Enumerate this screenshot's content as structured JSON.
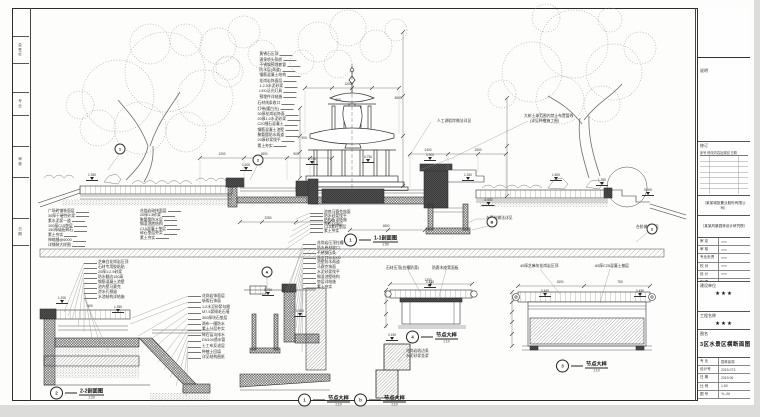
{
  "sheet": {
    "bg": "#dcdcda",
    "paper": "#fdfdfc",
    "line": "#333333"
  },
  "margin_blocks": [
    {
      "y": 36,
      "h": 26,
      "t": "会签栏"
    },
    {
      "y": 92,
      "h": 22,
      "t": "专业"
    },
    {
      "y": 146,
      "h": 30,
      "t": "审核"
    },
    {
      "y": 218,
      "h": 26,
      "t": "日期"
    }
  ],
  "stacks": [
    {
      "name": "fountain-upper-notes",
      "x": 300,
      "y": 52,
      "lh": 5.3,
      "anchor": "right",
      "leader": "right",
      "lines": [
        "黄锈石压顶",
        "涌泉喷头铜质",
        "不锈钢预埋套管",
        "防水层(两道)",
        "钢筋混凝土结构",
        "花岗岩饰面层",
        "1:2.5水泥砂浆",
        "LED泛光灯具",
        "预埋件详结施"
      ]
    },
    {
      "name": "fountain-lower-notes",
      "x": 300,
      "y": 101,
      "lh": 5.3,
      "anchor": "right",
      "leader": "right",
      "lines": [
        "石材线条收口",
        "灯带(暖白光)",
        "30厚花岗岩饰面",
        "20厚1:2水泥砂浆",
        "C20细石混凝土",
        "钢筋混凝土池壁",
        "聚氨酯防水两道",
        "20厚砂浆找平",
        "素土夯实"
      ]
    },
    {
      "name": "paving-layers-notes",
      "x": 48,
      "y": 209,
      "lh": 4.9,
      "anchor": "left",
      "leader": "right",
      "lines": [
        "广场砖铺装面层",
        "30厚干硬性砂浆",
        "素水泥浆一道",
        "100厚C15垫层",
        "150厚级配碎石",
        "素土夯实",
        "伸缩缝@6000",
        "详铺装大样图"
      ]
    },
    {
      "name": "pool-floor-notes",
      "x": 140,
      "y": 209,
      "lh": 4.5,
      "anchor": "left",
      "leader": "right",
      "lines": [
        "花岗岩碎拼面层",
        "20厚1:3砂浆",
        "聚氨酯防水层",
        "钢混池底结构",
        "C15混凝土垫层",
        "碎石垫层夯实",
        "素土夯实"
      ]
    },
    {
      "name": "basin-floor-notes",
      "x": 310,
      "y": 211,
      "lh": 3.9,
      "anchor": "left",
      "leader": "left",
      "lines": [
        "池底马赛克饰面",
        "防水砂浆找平",
        "结构板详结施",
        "陶粒回填层",
        "C15素砼垫层",
        "素土夯实"
      ]
    },
    {
      "name": "detailA-notes",
      "x": 303,
      "y": 241,
      "lh": 4.9,
      "anchor": "left",
      "leader": "left",
      "lines": [
        "花岗岩压顶拉槽",
        "防水卷材收口",
        "不锈钢压条",
        "溢水口@3000",
        "池壁防水两道",
        "马赛克饰面",
        "水泥砂浆找平",
        "钢混池壁结构",
        "垫层详结施",
        "素土夯实"
      ]
    },
    {
      "name": "detail1-top-notes",
      "x": 84,
      "y": 260,
      "lh": 5.0,
      "anchor": "left",
      "leader": "left",
      "lines": [
        "芝麻白花岗岩压顶",
        "石材专用胶粘贴",
        "20厚1:2.5砂浆",
        "防水翻边150高",
        "钢筋混凝土池壁",
        "池内壁马赛克",
        "泄水孔预留",
        "水池结构详结施"
      ]
    },
    {
      "name": "detail1-right-notes",
      "x": 188,
      "y": 293,
      "lh": 5.6,
      "anchor": "left",
      "leader": "left",
      "lines": [
        "花岗岩饰面层",
        "斩假石饰面",
        "1:2水泥砂浆勾缝",
        "M7.5浆砌毛石墙",
        "300厚块石垫层",
        "两布一膜防水",
        "素土分层夯实",
        "碎石盲沟排水",
        "DN100透水管",
        "土工布反滤层",
        "种植土回填",
        "详见结构图纸"
      ]
    }
  ],
  "notes": [
    {
      "x": 437,
      "y": 119,
      "t": "人工湖驳岸做法详见"
    },
    {
      "x": 524,
      "y": 114,
      "t": "大树土球范围内禁止布置管线"
    },
    {
      "x": 530,
      "y": 119,
      "t": "(详见种植施工图)"
    },
    {
      "x": 486,
      "y": 216,
      "t": "水泵坑做法详见"
    },
    {
      "x": 636,
      "y": 225,
      "t": "台阶做法详见"
    },
    {
      "x": 386,
      "y": 266,
      "t": "石材压顶(拉槽防滑)"
    },
    {
      "x": 432,
      "y": 266,
      "t": "防腐木座凳面板"
    },
    {
      "x": 520,
      "y": 264,
      "t": "40厚芝麻灰花岗岩压顶"
    },
    {
      "x": 595,
      "y": 264,
      "t": "60厚C25混凝土基层"
    },
    {
      "x": 406,
      "y": 349,
      "t": "花岗岩收边条"
    },
    {
      "x": 406,
      "y": 354,
      "t": "水泥砂浆坐浆"
    }
  ],
  "dim_texts": [
    {
      "x": 222,
      "y": 156,
      "t": "1200"
    },
    {
      "x": 264,
      "y": 156,
      "t": "1800"
    },
    {
      "x": 296,
      "y": 156,
      "t": "900"
    },
    {
      "x": 428,
      "y": 152,
      "t": "2400"
    },
    {
      "x": 478,
      "y": 152,
      "t": "1500"
    },
    {
      "x": 268,
      "y": 220,
      "t": "2250"
    },
    {
      "x": 386,
      "y": 228,
      "t": "1800"
    },
    {
      "x": 348,
      "y": 86,
      "t": "1200"
    },
    {
      "x": 338,
      "y": 102,
      "t": "600"
    },
    {
      "x": 560,
      "y": 284,
      "t": "1500"
    },
    {
      "x": 620,
      "y": 284,
      "t": "750"
    },
    {
      "x": 428,
      "y": 282,
      "t": "1200"
    },
    {
      "x": 90,
      "y": 308,
      "t": "600"
    },
    {
      "x": 398,
      "y": 100,
      "t": "3600"
    },
    {
      "x": 304,
      "y": 140,
      "t": "900"
    }
  ],
  "elev_points": [
    {
      "x": 92,
      "y": 181,
      "v": "1.350"
    },
    {
      "x": 246,
      "y": 171,
      "v": "1.200"
    },
    {
      "x": 312,
      "y": 165,
      "v": "0.750"
    },
    {
      "x": 368,
      "y": 163,
      "v": "0.750"
    },
    {
      "x": 430,
      "y": 161,
      "v": "0.900"
    },
    {
      "x": 468,
      "y": 181,
      "v": "1.350"
    },
    {
      "x": 556,
      "y": 181,
      "v": "1.500"
    },
    {
      "x": 602,
      "y": 186,
      "v": "1.350"
    },
    {
      "x": 648,
      "y": 196,
      "v": "0.900"
    },
    {
      "x": 488,
      "y": 206,
      "v": "-0.600"
    },
    {
      "x": 62,
      "y": 304,
      "v": "1.200"
    },
    {
      "x": 118,
      "y": 313,
      "v": "1.350"
    },
    {
      "x": 268,
      "y": 296,
      "v": "0.750"
    },
    {
      "x": 300,
      "y": 317,
      "v": "0.300"
    },
    {
      "x": 430,
      "y": 288,
      "v": "0.450"
    },
    {
      "x": 545,
      "y": 297,
      "v": "0.450"
    },
    {
      "x": 640,
      "y": 297,
      "v": "0.450"
    },
    {
      "x": 392,
      "y": 341,
      "v": "0.150"
    }
  ],
  "callouts": [
    {
      "x": 267,
      "y": 272,
      "n": "A"
    },
    {
      "x": 258,
      "y": 160,
      "n": "2"
    },
    {
      "x": 492,
      "y": 222,
      "n": "B"
    },
    {
      "x": 652,
      "y": 229,
      "n": "2"
    },
    {
      "x": 120,
      "y": 149,
      "n": "1"
    }
  ],
  "detail_labels": [
    {
      "x": 344,
      "y": 240,
      "num": "1",
      "title": "1-1剖面图",
      "scale": "1:50"
    },
    {
      "x": 50,
      "y": 393,
      "num": "2",
      "title": "2-2剖面图",
      "scale": "1:20"
    },
    {
      "x": 298,
      "y": 400,
      "num": "1",
      "title": "节点大样",
      "scale": "1:10"
    },
    {
      "x": 406,
      "y": 337,
      "num": "4",
      "title": "节点大样",
      "scale": "1:10"
    },
    {
      "x": 354,
      "y": 400,
      "num": "b",
      "title": "节点大样",
      "scale": "1:10"
    },
    {
      "x": 556,
      "y": 366,
      "num": "3",
      "title": "节点大样",
      "scale": "1:10"
    }
  ],
  "titleblock": {
    "notes_label": "说明",
    "revision_label": "修订",
    "revision_cols": "序号 修改内容及原因 日期",
    "company1": "（某某城投置业股份有限公司）",
    "company2": "（某某风景园林设计研究院）",
    "fields": [
      {
        "k": "审 定",
        "v": "×××"
      },
      {
        "k": "审 核",
        "v": "×××"
      },
      {
        "k": "专业负责",
        "v": "×××"
      },
      {
        "k": "校 对",
        "v": "×××"
      },
      {
        "k": "设 计",
        "v": "×××"
      },
      {
        "k": "制 图",
        "v": "×××"
      }
    ],
    "client_label": "建设单位",
    "client": "★★★",
    "project_label": "工程名称",
    "project": "★★★",
    "drawing_label": "图名",
    "drawing_title": "3区水景区横断面图",
    "bottom": [
      {
        "k": "专 业",
        "v": "园林景观"
      },
      {
        "k": "设计号",
        "v": "2019-073"
      },
      {
        "k": "日 期",
        "v": "2019.06"
      },
      {
        "k": "比 例",
        "v": "1:50"
      },
      {
        "k": "图 号",
        "v": "YL-06"
      }
    ],
    "sheet_size": "A1 加长"
  }
}
